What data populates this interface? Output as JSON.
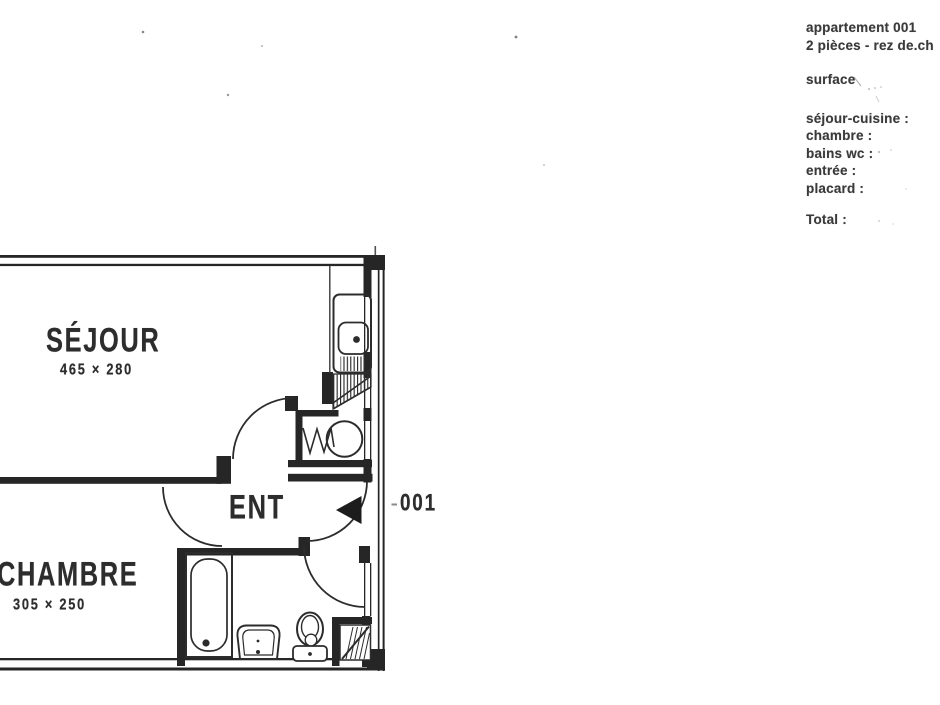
{
  "page": {
    "background": "#ffffff",
    "ink": "#2c2c2c"
  },
  "info_panel": {
    "line1": "appartement 001",
    "line2": "2 pièces - rez de.ch",
    "surface_label": "surface",
    "items": [
      {
        "label": "séjour-cuisine :"
      },
      {
        "label": "chambre :"
      },
      {
        "label": "bains wc :"
      },
      {
        "label": "entrée :"
      },
      {
        "label": "placard :"
      }
    ],
    "total_label": "Total :"
  },
  "floor_plan": {
    "unit_number": "001",
    "rooms": [
      {
        "name": "SÉJOUR",
        "dimensions": "465 × 280"
      },
      {
        "name": "CHAMBRE",
        "dimensions": "305 × 250"
      },
      {
        "name": "ENT",
        "dimensions": ""
      }
    ],
    "fixtures": [
      "kitchen-sink",
      "drainer",
      "water-heater",
      "bathtub",
      "washbasin",
      "toilet",
      "placard-hatch"
    ]
  }
}
